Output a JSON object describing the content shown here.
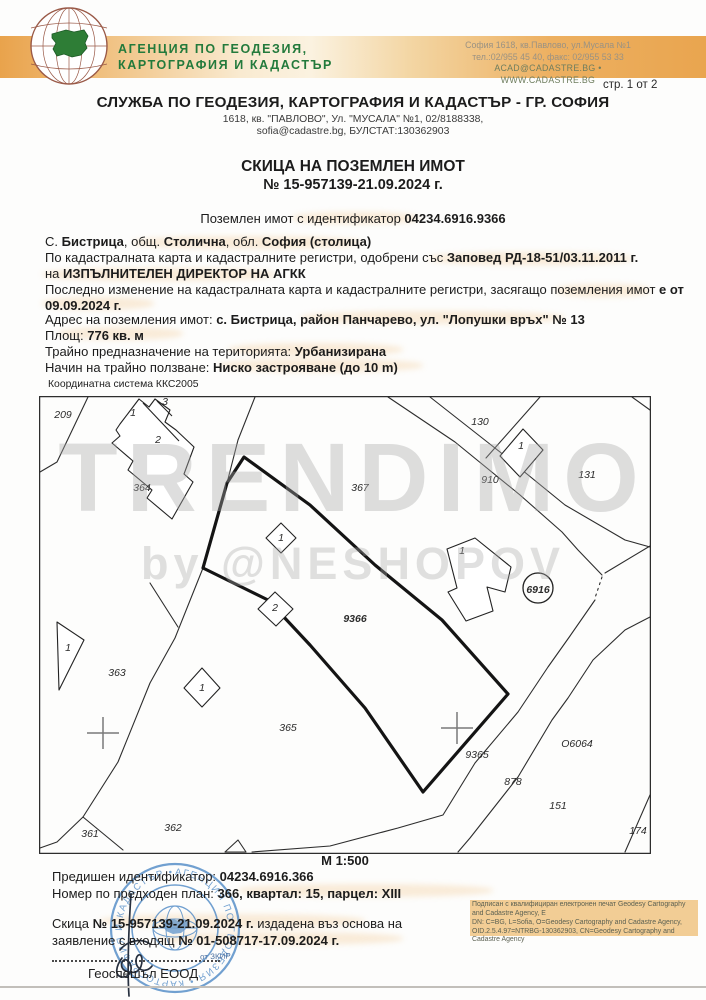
{
  "header": {
    "agency_line1": "АГЕНЦИЯ ПО ГЕОДЕЗИЯ,",
    "agency_line2": "КАРТОГРАФИЯ И КАДАСТЪР",
    "contact_line1": "София 1618, кв.Павлово, ул.Мусала №1",
    "contact_line2": "тел.:02/955 45 40, факс: 02/955 53 33",
    "contact_line3": "ACAD@CADASTRE.BG • WWW.CADASTRE.BG",
    "page_indicator": "стр. 1 от 2"
  },
  "office": {
    "title": "СЛУЖБА ПО ГЕОДЕЗИЯ, КАРТОГРАФИЯ И КАДАСТЪР - ГР. СОФИЯ",
    "address_line": "1618, кв. \"ПАВЛОВО\", Ул. \"МУСАЛА\" №1, 02/8188338,",
    "contact_line": "sofia@cadastre.bg, БУЛСТАТ:130362903"
  },
  "document": {
    "title": "СКИЦА НА ПОЗЕМЛЕН ИМОТ",
    "number": "№ 15-957139-21.09.2024 г.",
    "identifier_segments": [
      {
        "t": "Поземлен имот с идентификатор ",
        "b": 0
      },
      {
        "t": "04234.6916.9366",
        "b": 1
      }
    ]
  },
  "property": {
    "lines": [
      [
        {
          "t": "С. ",
          "b": 0
        },
        {
          "t": "Бистрица",
          "b": 1
        },
        {
          "t": ", общ. ",
          "b": 0
        },
        {
          "t": "Столична",
          "b": 1
        },
        {
          "t": ", обл. ",
          "b": 0
        },
        {
          "t": "София (столица)",
          "b": 1
        }
      ],
      [
        {
          "t": "По кадастралната карта и кадастралните регистри, одобрени със ",
          "b": 0
        },
        {
          "t": "Заповед РД-18-51/03.11.2011 г.",
          "b": 1
        }
      ],
      [
        {
          "t": "на ",
          "b": 0
        },
        {
          "t": "ИЗПЪЛНИТЕЛЕН ДИРЕКТОР НА АГКК",
          "b": 1
        }
      ],
      [
        {
          "t": "Последно изменение на кадастралната карта и кадастралните регистри, засягащо поземления имот ",
          "b": 0
        },
        {
          "t": "е от",
          "b": 1
        }
      ],
      [
        {
          "t": "09.09.2024 г.",
          "b": 1
        }
      ],
      [
        {
          "t": "Адрес на поземления имот: ",
          "b": 0
        },
        {
          "t": "с. Бистрица, район Панчарево, ул. \"Лопушки връх\" № 13",
          "b": 1
        }
      ],
      [
        {
          "t": "Площ: ",
          "b": 0
        },
        {
          "t": "776 кв. м",
          "b": 1
        }
      ],
      [
        {
          "t": "Трайно предназначение на територията: ",
          "b": 0
        },
        {
          "t": "Урбанизирана",
          "b": 1
        }
      ],
      [
        {
          "t": "Начин на трайно ползване: ",
          "b": 0
        },
        {
          "t": "Ниско застрояване (до 10 m)",
          "b": 1
        }
      ]
    ]
  },
  "map": {
    "coord_system": "Координатна система ККС2005",
    "scale": "М 1:500",
    "labels": [
      {
        "t": "209",
        "x": 24,
        "y": 22
      },
      {
        "t": "1",
        "x": 94,
        "y": 20
      },
      {
        "t": "3",
        "x": 126,
        "y": 9
      },
      {
        "t": "2",
        "x": 119,
        "y": 47
      },
      {
        "t": "364",
        "x": 103,
        "y": 95
      },
      {
        "t": "367",
        "x": 321,
        "y": 95
      },
      {
        "t": "130",
        "x": 441,
        "y": 29
      },
      {
        "t": "1",
        "x": 482,
        "y": 53
      },
      {
        "t": "910",
        "x": 451,
        "y": 87
      },
      {
        "t": "131",
        "x": 548,
        "y": 82
      },
      {
        "t": "1",
        "x": 423,
        "y": 158
      },
      {
        "t": "1",
        "x": 242,
        "y": 145
      },
      {
        "t": "9366",
        "x": 316,
        "y": 226,
        "b": 1
      },
      {
        "t": "2",
        "x": 236,
        "y": 215
      },
      {
        "t": "1",
        "x": 163,
        "y": 295
      },
      {
        "t": "1",
        "x": 29,
        "y": 255
      },
      {
        "t": "363",
        "x": 78,
        "y": 280
      },
      {
        "t": "365",
        "x": 249,
        "y": 335
      },
      {
        "t": "9365",
        "x": 438,
        "y": 362
      },
      {
        "t": "О6064",
        "x": 538,
        "y": 351,
        "fs": 12
      },
      {
        "t": "878",
        "x": 474,
        "y": 389
      },
      {
        "t": "151",
        "x": 519,
        "y": 413
      },
      {
        "t": "362",
        "x": 134,
        "y": 435
      },
      {
        "t": "361",
        "x": 51,
        "y": 441
      },
      {
        "t": "174",
        "x": 599,
        "y": 438
      },
      {
        "t": "6916",
        "x": 499,
        "y": 197,
        "fs": 12.5,
        "b": 1
      }
    ]
  },
  "watermark": {
    "line1": "TRENDIMO",
    "line2": "by @NESHOPOV"
  },
  "footer": {
    "prev_id": [
      {
        "t": "Предишен идентификатор: ",
        "b": 0
      },
      {
        "t": "04234.6916.366",
        "b": 1
      }
    ],
    "prev_plan": [
      {
        "t": "Номер по предходен план: ",
        "b": 0
      },
      {
        "t": "366, квартал: 15, парцел: XIII",
        "b": 1
      }
    ],
    "issue_line1": [
      {
        "t": "Скица ",
        "b": 0
      },
      {
        "t": "№ 15-957139-21.09.2024 г.",
        "b": 1
      },
      {
        "t": " издадена въз основа на",
        "b": 0
      }
    ],
    "issue_line2": [
      {
        "t": "заявление с входящ ",
        "b": 0
      },
      {
        "t": "№ 01-508717-17.09.2024 г.",
        "b": 1
      }
    ],
    "stamp_fragment": "от ЗКИР",
    "company": "Геоспешъл ЕООД",
    "stamp_circle_text": "АГЕНЦИЯ ПО ГЕОДЕЗИЯ • КАРТОГРАФИЯ И КАДАСТЪР •",
    "signature_block": {
      "line1": "Подписан с квалифициран електронен печат Geodesy Cartography",
      "line2": "and Cadastre Agency, E",
      "line3": "DN: C=BG, L=Sofia, O=Geodesy Cartography and Cadastre Agency,",
      "line4": "OID.2.5.4.97=NTRBG-130362903, CN=Geodesy Cartography and",
      "line5": "Cadastre Agency"
    }
  }
}
